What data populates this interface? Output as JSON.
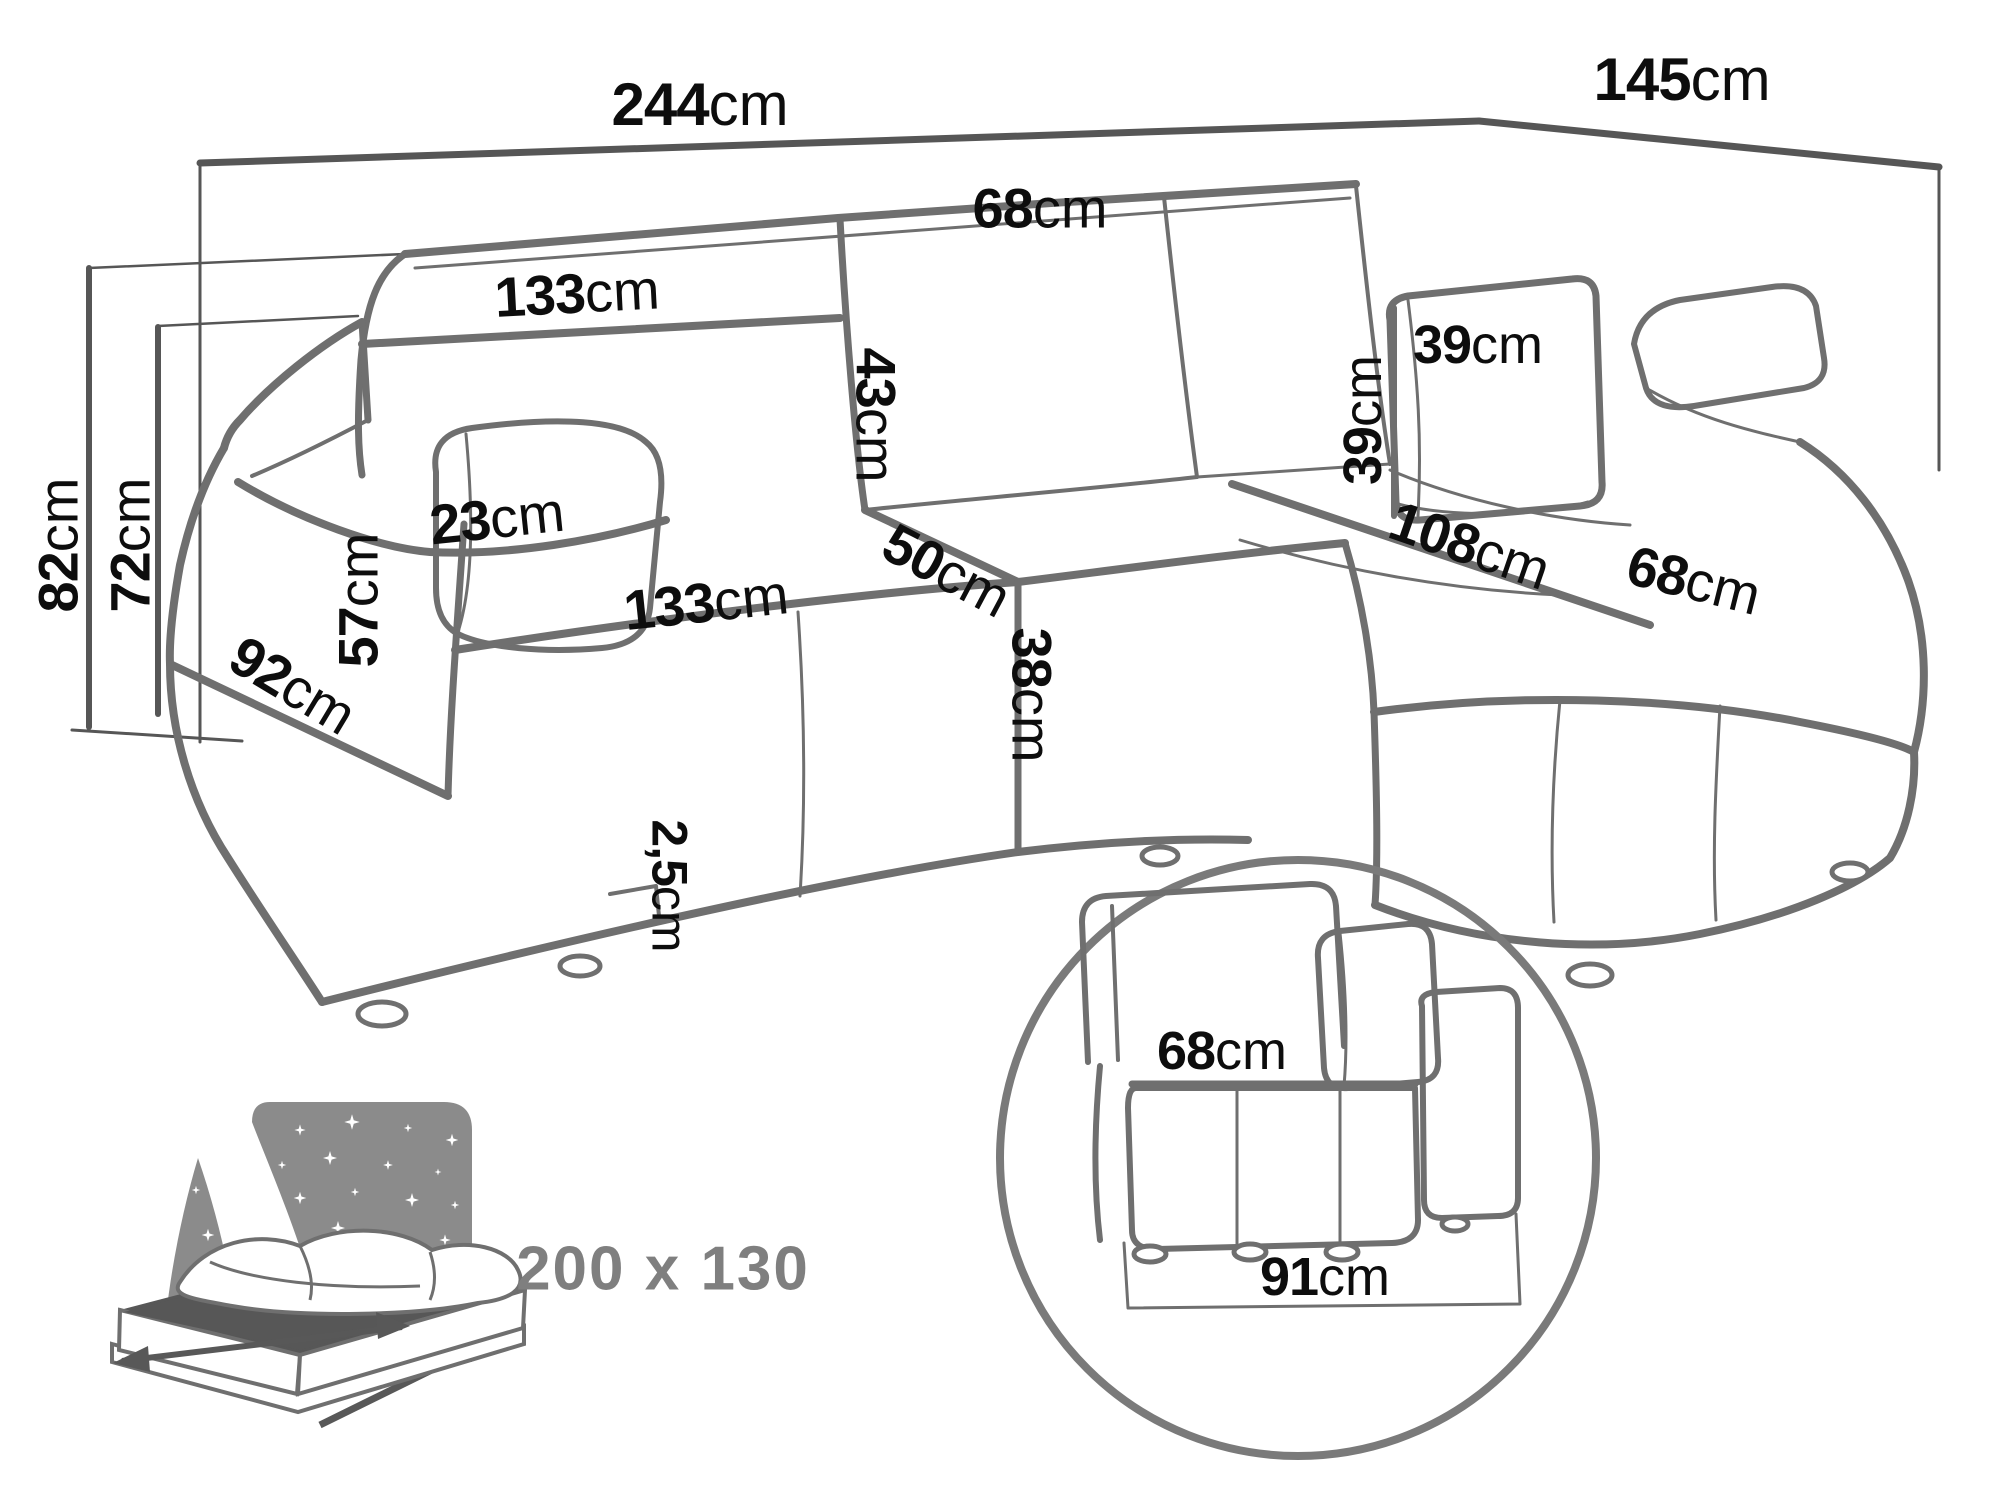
{
  "colors": {
    "background": "#ffffff",
    "sofa_line": "#6f6f6f",
    "dimension_line": "#565656",
    "text": "#0d0d0d",
    "muted_gray": "#7f7f7f",
    "bed_icon_gray": "#8b8b8b",
    "bed_top_dark": "#575757"
  },
  "diagram": {
    "type": "furniture-dimension-diagram",
    "subject": "corner sofa bed with chaise and sleeping function"
  },
  "labels": {
    "total_width": {
      "num": "244",
      "unit": "cm"
    },
    "total_depth": {
      "num": "145",
      "unit": "cm"
    },
    "back_cushion_width_right": {
      "num": "68",
      "unit": "cm"
    },
    "back_cushion_width_left": {
      "num": "133",
      "unit": "cm"
    },
    "back_cushion_height": {
      "num": "43",
      "unit": "cm"
    },
    "pillow_width": {
      "num": "39",
      "unit": "cm"
    },
    "pillow_height": {
      "num": "39",
      "unit": "cm"
    },
    "armrest_width": {
      "num": "23",
      "unit": "cm"
    },
    "chaise_length": {
      "num": "108",
      "unit": "cm"
    },
    "chaise_width": {
      "num": "68",
      "unit": "cm"
    },
    "seat_width": {
      "num": "133",
      "unit": "cm"
    },
    "seat_depth": {
      "num": "50",
      "unit": "cm"
    },
    "armrest_height": {
      "num": "57",
      "unit": "cm"
    },
    "armrest_depth": {
      "num": "92",
      "unit": "cm"
    },
    "total_height": {
      "num": "82",
      "unit": "cm"
    },
    "height_without_cushions": {
      "num": "72",
      "unit": "cm"
    },
    "seat_height": {
      "num": "38",
      "unit": "cm"
    },
    "ground_clearance": {
      "num": "2,5",
      "unit": "cm"
    },
    "inset_seat_height": {
      "num": "68",
      "unit": "cm"
    },
    "inset_base_width": {
      "num": "91",
      "unit": "cm"
    }
  },
  "sleeping_area": {
    "label": "200 x 130"
  }
}
